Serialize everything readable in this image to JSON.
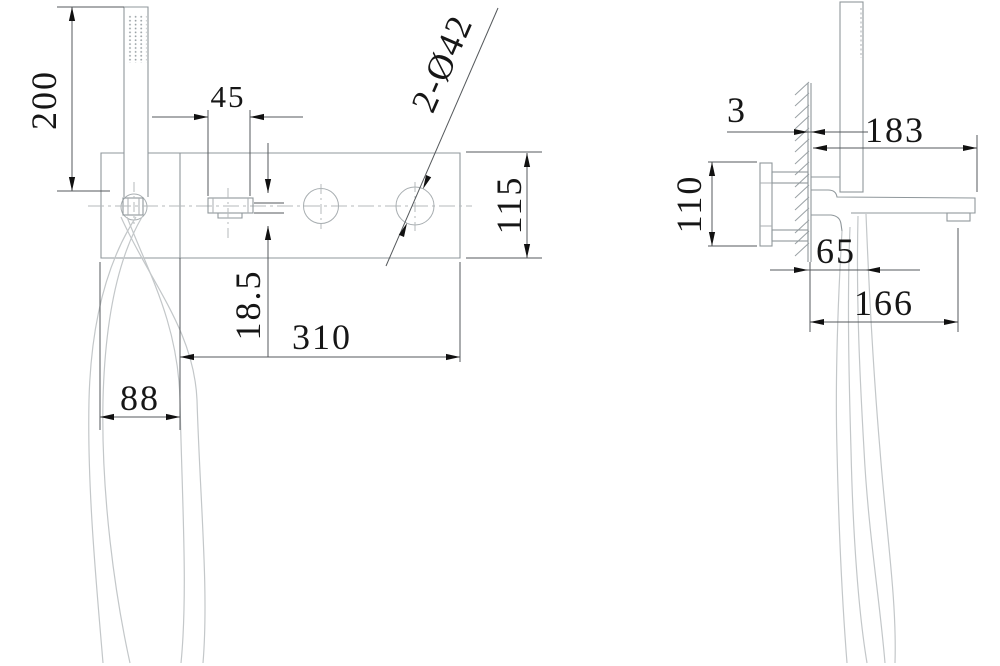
{
  "front_view": {
    "dim_height": "200",
    "dim_spout_width": "45",
    "label_holes": "2-Ø42",
    "dim_plate_height": "115",
    "dim_offset": "18.5",
    "dim_plate_width": "310",
    "dim_hose_width": "88"
  },
  "side_view": {
    "dim_wall_plate": "3",
    "dim_reach_top": "183",
    "dim_body_height": "110",
    "dim_offset": "65",
    "dim_reach_bottom": "166"
  }
}
